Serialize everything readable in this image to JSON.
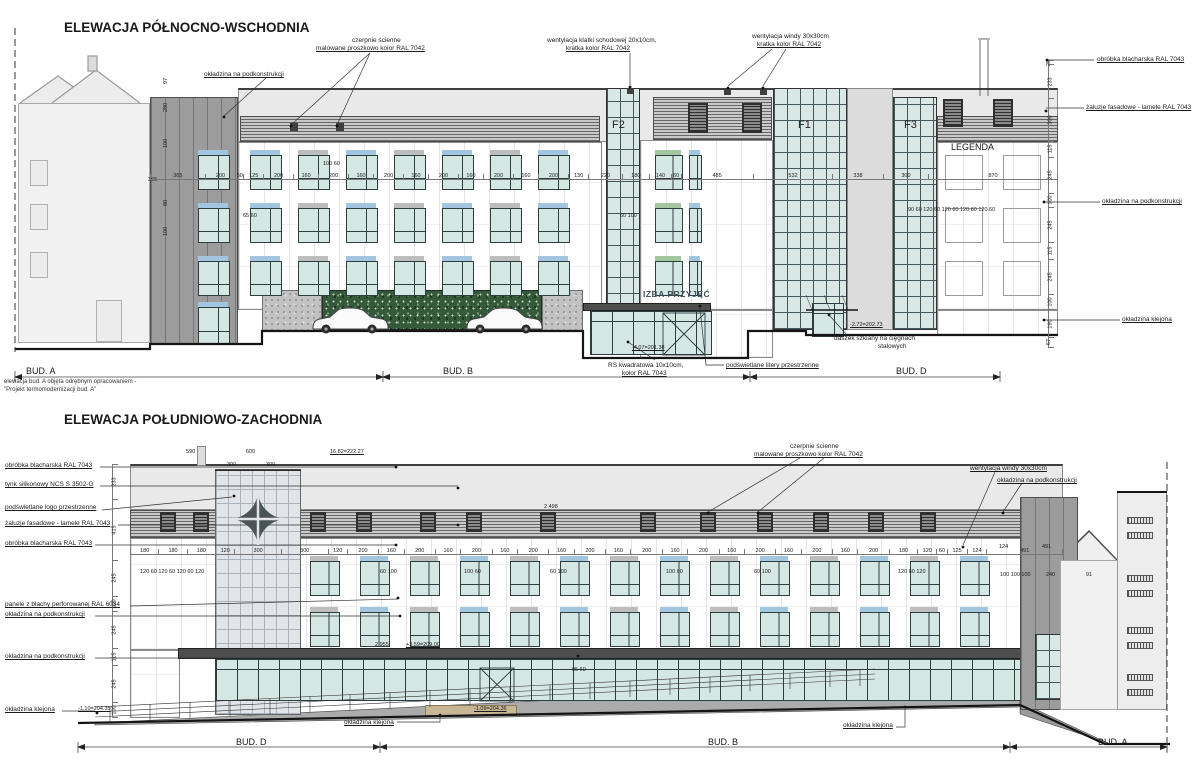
{
  "titles": {
    "northeast": "ELEWACJA PÓŁNOCNO-WSCHODNIA",
    "southwest": "ELEWACJA POŁUDNIOWO-ZACHODNIA"
  },
  "signs": {
    "entrance_sign": "IZBA PRZYJĘĆ",
    "legend": "LEGENDA",
    "towers": {
      "f1": "F1",
      "f2": "F2",
      "f3": "F3"
    }
  },
  "building_sections": {
    "top": [
      "BUD. A",
      "BUD. B",
      "BUD. D"
    ],
    "bottom": [
      "BUD. D",
      "BUD. B",
      "BUD. A"
    ]
  },
  "notes": {
    "bud_a_line1": "elewacja bud. A objęta odrębnym opracowaniem -",
    "bud_a_line2": "\"Projekt termomodernizacji bud. A\""
  },
  "colors": {
    "accent_green": "#a4c79f",
    "accent_gray": "#bdbdbd",
    "accent_blue": "#a3c6e0",
    "glass": "#d9e8e5",
    "sign": "#41545e",
    "clad_dark": "#9c9c9c",
    "canopy": "#4d4d4d",
    "greenwall": "#35593b"
  },
  "annotations": [
    {
      "t": "okładzina na podkonstrukcji",
      "x": 204,
      "y": 71,
      "u": 1
    },
    {
      "t": "czerpnie ścienne",
      "x": 352,
      "y": 37
    },
    {
      "t": "malowane proszkowo kolor RAL 7042",
      "x": 316,
      "y": 45,
      "u": 1
    },
    {
      "t": "wentylacja klatki schodowej 20x10cm,",
      "x": 547,
      "y": 37
    },
    {
      "t": "kratka kolor RAL 7042",
      "x": 566,
      "y": 45,
      "u": 1
    },
    {
      "t": "wentylacja windy 30x30cm",
      "x": 752,
      "y": 33
    },
    {
      "t": "kratka kolor RAL 7042",
      "x": 757,
      "y": 41,
      "u": 1
    },
    {
      "t": "obróbka blacharska RAL 7043",
      "x": 1097,
      "y": 56,
      "u": 1
    },
    {
      "t": "żaluzje fasadowe - lamele RAL 7043",
      "x": 1086,
      "y": 104,
      "u": 1
    },
    {
      "t": "okładzina na podkonstrukcji",
      "x": 1102,
      "y": 198,
      "u": 1
    },
    {
      "t": "okładzina klejona",
      "x": 1122,
      "y": 316,
      "u": 1
    },
    {
      "t": "RS kwadratowa 10x10cm,",
      "x": 608,
      "y": 362
    },
    {
      "t": "kolor RAL 7043",
      "x": 622,
      "y": 370,
      "u": 1
    },
    {
      "t": "podświetlane litery przestrzenne",
      "x": 726,
      "y": 362,
      "u": 1
    },
    {
      "t": "-2.72=202.73",
      "x": 850,
      "y": 322,
      "u": 1,
      "fs": 5.5
    },
    {
      "t": "daszek szklany na cięgnach",
      "x": 834,
      "y": 335
    },
    {
      "t": "stalowych",
      "x": 878,
      "y": 343
    },
    {
      "t": "-4.07=201.38",
      "x": 632,
      "y": 345,
      "u": 1,
      "fs": 5.5
    },
    {
      "t": "100  60",
      "x": 323,
      "y": 161,
      "fs": 5.5
    },
    {
      "t": "65  60",
      "x": 243,
      "y": 213,
      "fs": 5.5
    },
    {
      "t": "60  100",
      "x": 620,
      "y": 213,
      "fs": 5.5
    },
    {
      "t": "90  60  120  60  120  60  120  60  120  60",
      "x": 908,
      "y": 207,
      "fs": 5.5
    },
    {
      "t": "97",
      "x": 163,
      "y": 84,
      "r": 1
    },
    {
      "t": "280",
      "x": 163,
      "y": 112,
      "r": 1
    },
    {
      "t": "100",
      "x": 163,
      "y": 148,
      "r": 1
    },
    {
      "t": "365",
      "x": 148,
      "y": 177,
      "fs": 5.5
    },
    {
      "t": "80",
      "x": 163,
      "y": 206,
      "r": 1
    },
    {
      "t": "100",
      "x": 163,
      "y": 236,
      "r": 1
    },
    {
      "t": "obróbka blacharska RAL 7043",
      "x": 5,
      "y": 462,
      "u": 1
    },
    {
      "t": "tynk silikonowy NCS S 3502-G",
      "x": 5,
      "y": 481,
      "u": 1
    },
    {
      "t": "podświetlane logo przestrzenne",
      "x": 5,
      "y": 504,
      "u": 1
    },
    {
      "t": "żaluzje fasadowe - lamele RAL 7043",
      "x": 5,
      "y": 520,
      "u": 1
    },
    {
      "t": "obróbka blacharska RAL 7043",
      "x": 5,
      "y": 540,
      "u": 1
    },
    {
      "t": "panele z blachy perforowanej RAL 6034",
      "x": 5,
      "y": 601,
      "u": 1
    },
    {
      "t": "okładzina na podkonstrukcji",
      "x": 5,
      "y": 611,
      "u": 1
    },
    {
      "t": "okładzina na podkonstrukcji",
      "x": 5,
      "y": 653,
      "u": 1
    },
    {
      "t": "okładzina klejona",
      "x": 5,
      "y": 706,
      "u": 1
    },
    {
      "t": "czerpnie ścienne",
      "x": 790,
      "y": 443
    },
    {
      "t": "malowane proszkowo kolor RAL 7042",
      "x": 754,
      "y": 451,
      "u": 1
    },
    {
      "t": "wentylacja windy 30x30cm",
      "x": 970,
      "y": 465,
      "u": 1
    },
    {
      "t": "okładzina na podkonstrukcji",
      "x": 997,
      "y": 477,
      "u": 1
    },
    {
      "t": "16.82=222.27",
      "x": 330,
      "y": 449,
      "u": 1,
      "fs": 5.5
    },
    {
      "t": "590",
      "x": 186,
      "y": 449,
      "fs": 5.5
    },
    {
      "t": "600",
      "x": 246,
      "y": 449,
      "fs": 5.5
    },
    {
      "t": "300",
      "x": 227,
      "y": 462,
      "fs": 5.5
    },
    {
      "t": "300",
      "x": 266,
      "y": 462,
      "fs": 5.5
    },
    {
      "t": "2 498",
      "x": 544,
      "y": 504,
      "fs": 5.5
    },
    {
      "t": "2 955",
      "x": 375,
      "y": 642,
      "fs": 5.5
    },
    {
      "t": "+3.59=209.00",
      "x": 406,
      "y": 642,
      "u": 1,
      "fs": 5.5
    },
    {
      "t": "95  60",
      "x": 572,
      "y": 667,
      "fs": 5.5
    },
    {
      "t": "okładzina klejona",
      "x": 344,
      "y": 719,
      "u": 1
    },
    {
      "t": "okładzina klejona",
      "x": 843,
      "y": 722,
      "u": 1
    },
    {
      "t": "-1.10=204.35",
      "x": 78,
      "y": 706,
      "u": 1,
      "fs": 5.5
    },
    {
      "t": "-1.09=204.36",
      "x": 474,
      "y": 706,
      "u": 1,
      "fs": 5.5
    },
    {
      "t": "120 60 120 60 120 60 120",
      "x": 140,
      "y": 569,
      "fs": 5.5
    },
    {
      "t": "60 100",
      "x": 380,
      "y": 569,
      "fs": 5.5
    },
    {
      "t": "100 60",
      "x": 464,
      "y": 569,
      "fs": 5.5
    },
    {
      "t": "60 100",
      "x": 550,
      "y": 569,
      "fs": 5.5
    },
    {
      "t": "100 60",
      "x": 666,
      "y": 569,
      "fs": 5.5
    },
    {
      "t": "60 100",
      "x": 754,
      "y": 569,
      "fs": 5.5
    },
    {
      "t": "120 60 120",
      "x": 898,
      "y": 569,
      "fs": 5.5
    },
    {
      "t": "100 100 100",
      "x": 1000,
      "y": 572,
      "fs": 5.5
    },
    {
      "t": "240",
      "x": 1046,
      "y": 572,
      "fs": 5.5
    },
    {
      "t": "91",
      "x": 1086,
      "y": 572,
      "fs": 5.5
    },
    {
      "t": "124",
      "x": 999,
      "y": 544,
      "fs": 5.5
    },
    {
      "t": "491",
      "x": 1042,
      "y": 544,
      "fs": 5.5
    }
  ],
  "dim_chains": [
    {
      "o": "h",
      "x0": 150,
      "x1": 1058,
      "y": 170,
      "vals": [
        365,
        200,
        50,
        125,
        200,
        160,
        200,
        160,
        200,
        160,
        200,
        160,
        200,
        160,
        200,
        130,
        220,
        180,
        140,
        60,
        485,
        532,
        338,
        300,
        870
      ]
    },
    {
      "o": "v",
      "x": 1048,
      "y0": 60,
      "y1": 348,
      "vals": [
        25,
        233,
        300,
        115,
        245,
        100,
        245,
        115,
        245,
        100,
        190,
        67
      ]
    },
    {
      "o": "h",
      "x0": 130,
      "x1": 1063,
      "y": 545,
      "vals": [
        180,
        180,
        180,
        120,
        300,
        300,
        120,
        200,
        160,
        200,
        160,
        200,
        160,
        200,
        160,
        200,
        160,
        200,
        160,
        200,
        160,
        200,
        160,
        200,
        160,
        200,
        180,
        120,
        60,
        125,
        124,
        491
      ]
    },
    {
      "o": "v",
      "x": 112,
      "y0": 464,
      "y1": 718,
      "vals": [
        233,
        415,
        245,
        100,
        245,
        115,
        245,
        100
      ]
    }
  ],
  "facade": {
    "window_rows": [
      {
        "x": 198,
        "y": 150,
        "count": 1,
        "pitch": 0,
        "w": 30,
        "h": 38
      },
      {
        "x": 198,
        "y": 203,
        "count": 1,
        "pitch": 0,
        "w": 30,
        "h": 38
      },
      {
        "x": 198,
        "y": 256,
        "count": 1,
        "pitch": 0,
        "w": 30,
        "h": 38
      },
      {
        "x": 198,
        "y": 302,
        "count": 1,
        "pitch": 0,
        "w": 30,
        "h": 40
      },
      {
        "x": 250,
        "y": 150,
        "count": 7,
        "pitch": 48,
        "w": 30,
        "h": 38
      },
      {
        "x": 250,
        "y": 203,
        "count": 7,
        "pitch": 48,
        "w": 30,
        "h": 38
      },
      {
        "x": 250,
        "y": 256,
        "count": 7,
        "pitch": 48,
        "w": 30,
        "h": 38
      },
      {
        "x": 655,
        "y": 150,
        "widths": [
          26,
          11
        ],
        "gap": 8,
        "h": 38
      },
      {
        "x": 655,
        "y": 203,
        "widths": [
          26,
          11
        ],
        "gap": 8,
        "h": 38
      },
      {
        "x": 655,
        "y": 256,
        "widths": [
          26,
          11
        ],
        "gap": 8,
        "h": 38
      },
      {
        "x": 945,
        "y": 150,
        "count": 2,
        "pitch": 58,
        "w": 36,
        "h": 38,
        "o": 1
      },
      {
        "x": 945,
        "y": 203,
        "count": 2,
        "pitch": 58,
        "w": 36,
        "h": 38,
        "o": 1
      },
      {
        "x": 945,
        "y": 256,
        "count": 2,
        "pitch": 58,
        "w": 36,
        "h": 38,
        "o": 1
      },
      {
        "x": 310,
        "y": 556,
        "count": 14,
        "pitch": 50,
        "w": 28,
        "h": 38
      },
      {
        "x": 310,
        "y": 607,
        "count": 14,
        "pitch": 50,
        "w": 28,
        "h": 38
      }
    ],
    "vents": [
      {
        "x": 290,
        "y": 123,
        "w": 8,
        "h": 8,
        "c": "v"
      },
      {
        "x": 336,
        "y": 123,
        "w": 8,
        "h": 8,
        "c": "v"
      },
      {
        "x": 627,
        "y": 88,
        "w": 7,
        "h": 6,
        "c": "v"
      },
      {
        "x": 724,
        "y": 89,
        "w": 7,
        "h": 6,
        "c": "v"
      },
      {
        "x": 760,
        "y": 89,
        "w": 7,
        "h": 6,
        "c": "v"
      },
      {
        "x": 688,
        "y": 103,
        "w": 20,
        "h": 30,
        "c": "vb"
      },
      {
        "x": 742,
        "y": 103,
        "w": 20,
        "h": 30,
        "c": "vb"
      },
      {
        "x": 943,
        "y": 99,
        "w": 20,
        "h": 28,
        "c": "vb"
      },
      {
        "x": 993,
        "y": 99,
        "w": 20,
        "h": 28,
        "c": "vb"
      },
      {
        "x": 160,
        "y": 512,
        "w": 16,
        "h": 20,
        "c": "vb"
      },
      {
        "x": 193,
        "y": 512,
        "w": 16,
        "h": 20,
        "c": "vb"
      },
      {
        "x": 310,
        "y": 512,
        "w": 16,
        "h": 20,
        "c": "vb"
      },
      {
        "x": 356,
        "y": 512,
        "w": 16,
        "h": 20,
        "c": "vb"
      },
      {
        "x": 420,
        "y": 512,
        "w": 16,
        "h": 20,
        "c": "vb"
      },
      {
        "x": 466,
        "y": 512,
        "w": 16,
        "h": 20,
        "c": "vb"
      },
      {
        "x": 540,
        "y": 512,
        "w": 16,
        "h": 20,
        "c": "vb"
      },
      {
        "x": 640,
        "y": 512,
        "w": 16,
        "h": 20,
        "c": "vb"
      },
      {
        "x": 700,
        "y": 512,
        "w": 16,
        "h": 20,
        "c": "vb"
      },
      {
        "x": 757,
        "y": 512,
        "w": 16,
        "h": 20,
        "c": "vb"
      },
      {
        "x": 813,
        "y": 512,
        "w": 16,
        "h": 20,
        "c": "vb"
      },
      {
        "x": 868,
        "y": 512,
        "w": 16,
        "h": 20,
        "c": "vb"
      },
      {
        "x": 920,
        "y": 512,
        "w": 16,
        "h": 20,
        "c": "vb"
      },
      {
        "x": 1127,
        "y": 517,
        "w": 26,
        "h": 7,
        "c": "bv"
      },
      {
        "x": 1127,
        "y": 532,
        "w": 26,
        "h": 7,
        "c": "bv"
      },
      {
        "x": 1127,
        "y": 575,
        "w": 26,
        "h": 7,
        "c": "bv"
      },
      {
        "x": 1127,
        "y": 590,
        "w": 26,
        "h": 7,
        "c": "bv"
      },
      {
        "x": 1127,
        "y": 627,
        "w": 26,
        "h": 7,
        "c": "bv"
      },
      {
        "x": 1127,
        "y": 642,
        "w": 26,
        "h": 7,
        "c": "bv"
      },
      {
        "x": 1127,
        "y": 674,
        "w": 26,
        "h": 7,
        "c": "bv"
      },
      {
        "x": 1127,
        "y": 689,
        "w": 26,
        "h": 7,
        "c": "bv"
      }
    ]
  }
}
